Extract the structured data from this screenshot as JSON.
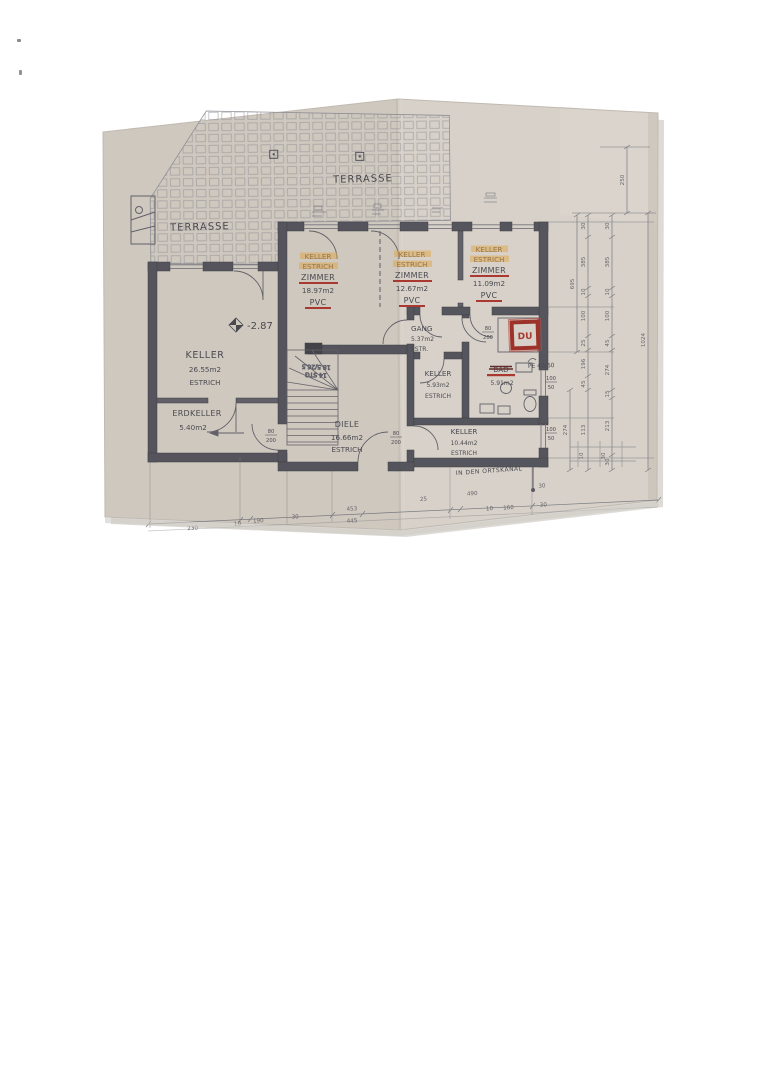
{
  "paper": {
    "color": "#d3ccc4",
    "left_half": "#cfc8bf",
    "right_half": "#d7d1c9"
  },
  "colors": {
    "wall": "#4c4c55",
    "ink": "#3f3f47",
    "red": "#a62e26",
    "stamp_red": "#99271f",
    "marker": "#e2a23b"
  },
  "plan": {
    "terrace_left": "TERRASSE",
    "terrace_right": "TERRASSE",
    "elevation": "-2.87",
    "stair_line1": "14 STG",
    "stair_line2": "18.5/26.5",
    "du_stamp": "DU",
    "pipe_label": "PE 40/60",
    "canal_label": "IN DEN ORTSKANAL",
    "door_size_top": "80",
    "door_size_bottom": "200",
    "window_size_top": "100",
    "window_size_bottom": "50"
  },
  "rooms": {
    "zimmer1": {
      "old_name": "KELLER",
      "old_floor": "ESTRICH",
      "new_name": "ZIMMER",
      "area": "18.97m2",
      "floor": "PVC"
    },
    "zimmer2": {
      "old_name": "KELLER",
      "old_floor": "ESTRICH",
      "new_name": "ZIMMER",
      "area": "12.67m2",
      "floor": "PVC"
    },
    "zimmer3": {
      "old_name": "KELLER",
      "old_floor": "ESTRICH",
      "new_name": "ZIMMER",
      "area": "11.09m2",
      "floor": "PVC"
    },
    "keller_big": {
      "name": "KELLER",
      "area": "26.55m2",
      "floor": "ESTRICH"
    },
    "erdkeller": {
      "name": "ERDKELLER",
      "area": "5.40m2"
    },
    "diele": {
      "name": "DIELE",
      "area": "16.66m2",
      "floor": "ESTRICH"
    },
    "gang": {
      "name": "GANG",
      "area": "5.37m2",
      "floor": "ESTR."
    },
    "keller_klein": {
      "name": "KELLER",
      "area": "5.93m2",
      "floor": "ESTRICH"
    },
    "keller_mittel": {
      "name": "KELLER",
      "area": "10.44m2",
      "floor": "ESTRICH"
    },
    "bad": {
      "old_name": "BAD",
      "area": "5.91m2"
    }
  },
  "dims": {
    "top": "250",
    "total": "1024",
    "mid": "695",
    "sub": "274",
    "chain_a": [
      "30",
      "385",
      "10",
      "100",
      "25",
      "196",
      "45",
      "113"
    ],
    "chain_b": [
      "30",
      "385",
      "10",
      "100",
      "45",
      "274",
      "15",
      "213",
      "30"
    ],
    "bottom_row1": [
      "230",
      "10",
      "190",
      "30",
      "453",
      "25",
      "490",
      "30"
    ],
    "bottom_row2": [
      "445",
      "10",
      "160",
      "30"
    ],
    "corner": [
      "10",
      "30"
    ]
  }
}
